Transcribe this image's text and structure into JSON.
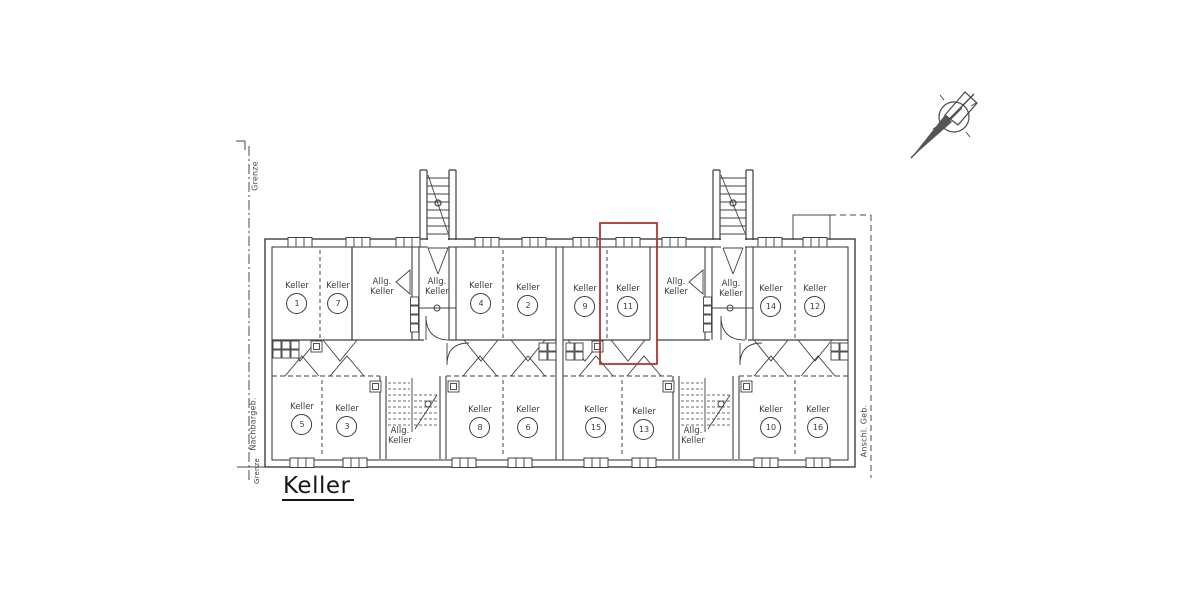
{
  "drawing": {
    "title": "Keller",
    "line_color": "#404040",
    "highlight": {
      "room_label": "Keller",
      "room_number": "11",
      "color": "#b0362e"
    },
    "boundary_labels": {
      "grenze_top": "Grenze",
      "nachbargeb": "Nachbargeb.",
      "grenze_bottom": "Grenze",
      "anschl_geb": "Anschl. Geb."
    },
    "north_arrow": "compass-north-needle",
    "rooms": [
      {
        "type": "keller",
        "label": "Keller",
        "number": "1",
        "x": 297,
        "y": 281
      },
      {
        "type": "keller",
        "label": "Keller",
        "number": "7",
        "x": 338,
        "y": 281
      },
      {
        "type": "allg",
        "line1": "Allg.",
        "line2": "Keller",
        "x": 382,
        "y": 277
      },
      {
        "type": "allg",
        "line1": "Allg.",
        "line2": "Keller",
        "x": 437,
        "y": 277
      },
      {
        "type": "keller",
        "label": "Keller",
        "number": "4",
        "x": 481,
        "y": 281
      },
      {
        "type": "keller",
        "label": "Keller",
        "number": "2",
        "x": 528,
        "y": 283
      },
      {
        "type": "keller",
        "label": "Keller",
        "number": "9",
        "x": 585,
        "y": 284
      },
      {
        "type": "keller",
        "label": "Keller",
        "number": "11",
        "x": 628,
        "y": 284
      },
      {
        "type": "allg",
        "line1": "Allg.",
        "line2": "Keller",
        "x": 676,
        "y": 277
      },
      {
        "type": "allg",
        "line1": "Allg.",
        "line2": "Keller",
        "x": 731,
        "y": 279
      },
      {
        "type": "keller",
        "label": "Keller",
        "number": "14",
        "x": 771,
        "y": 284
      },
      {
        "type": "keller",
        "label": "Keller",
        "number": "12",
        "x": 815,
        "y": 284
      },
      {
        "type": "keller",
        "label": "Keller",
        "number": "5",
        "x": 302,
        "y": 402
      },
      {
        "type": "keller",
        "label": "Keller",
        "number": "3",
        "x": 347,
        "y": 404
      },
      {
        "type": "allg",
        "line1": "Allg.",
        "line2": "Keller",
        "x": 400,
        "y": 426
      },
      {
        "type": "keller",
        "label": "Keller",
        "number": "8",
        "x": 480,
        "y": 405
      },
      {
        "type": "keller",
        "label": "Keller",
        "number": "6",
        "x": 528,
        "y": 405
      },
      {
        "type": "keller",
        "label": "Keller",
        "number": "15",
        "x": 596,
        "y": 405
      },
      {
        "type": "keller",
        "label": "Keller",
        "number": "13",
        "x": 644,
        "y": 407
      },
      {
        "type": "allg",
        "line1": "Allg.",
        "line2": "Keller",
        "x": 693,
        "y": 426
      },
      {
        "type": "keller",
        "label": "Keller",
        "number": "10",
        "x": 771,
        "y": 405
      },
      {
        "type": "keller",
        "label": "Keller",
        "number": "16",
        "x": 818,
        "y": 405
      }
    ]
  }
}
